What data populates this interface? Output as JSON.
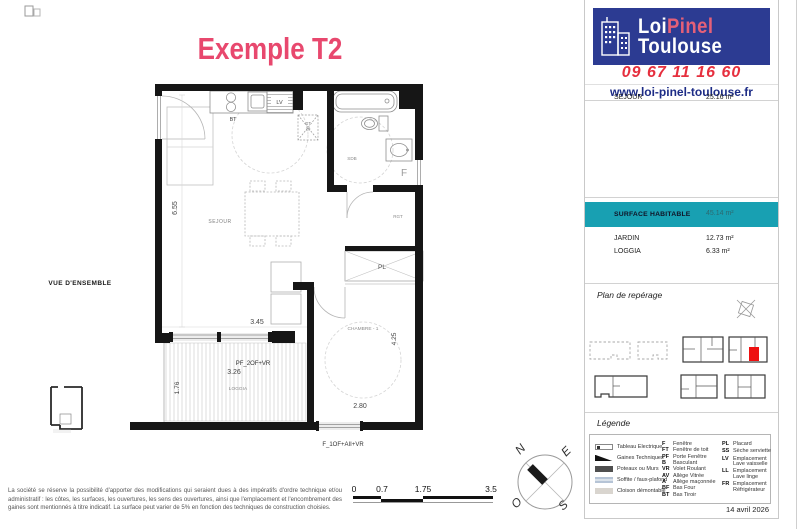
{
  "colors": {
    "accent_pink": "#e8486e",
    "brand_blue": "#2c3b92",
    "phone_red": "#e62f3e",
    "link_blue": "#1d2c86",
    "teal": "#18a0b2",
    "unit_red": "#ee1010"
  },
  "header": {
    "title": "Exemple T2"
  },
  "branding": {
    "logo_word1": "Loi",
    "logo_word2": "Pinel",
    "logo_word3": "Toulouse",
    "phone": "09 67 11 16 60",
    "website": "www.loi-pinel-toulouse.fr"
  },
  "areas": {
    "rows": [
      {
        "label": "SEJOUR",
        "value": "25.16 m²"
      }
    ],
    "highlight": {
      "label": "SURFACE HABITABLE",
      "value": "45.14 m²"
    },
    "annex_rows": [
      {
        "label": "JARDIN",
        "value": "12.73 m²"
      },
      {
        "label": "LOGGIA",
        "value": "6.33 m²"
      }
    ]
  },
  "reperage": {
    "title": "Plan de repérage"
  },
  "legend": {
    "title": "Légende",
    "materials": [
      {
        "name": "Tableau Electrique"
      },
      {
        "name": "Gaines Techniques"
      },
      {
        "name": "Poteaux ou Murs"
      },
      {
        "name": "Soffite / faux-plafond"
      },
      {
        "name": "Cloison démontable"
      }
    ],
    "codes": [
      {
        "code": "F",
        "label": "Fenêtre"
      },
      {
        "code": "FT",
        "label": "Fenêtre de toit"
      },
      {
        "code": "PF",
        "label": "Porte Fenêtre"
      },
      {
        "code": "B",
        "label": "Basculant"
      },
      {
        "code": "VR",
        "label": "Volet Roulant"
      },
      {
        "code": "AV",
        "label": "Allège Vitrée"
      },
      {
        "code": "A",
        "label": "Allège maçonnée"
      },
      {
        "code": "BF",
        "label": "Bas Four"
      },
      {
        "code": "BT",
        "label": "Bas Tiroir"
      }
    ],
    "codes2": [
      {
        "code": "PL",
        "label": "Placard"
      },
      {
        "code": "SS",
        "label": "Sèche serviette"
      },
      {
        "code": "LV",
        "label": "Emplacement Lave vaisselle"
      },
      {
        "code": "LL",
        "label": "Emplacement Lave linge"
      },
      {
        "code": "FR",
        "label": "Emplacement Réfrigérateur"
      }
    ]
  },
  "plan": {
    "view_label": "VUE D'ENSEMBLE",
    "labels": {
      "sejour": "SEJOUR",
      "sdb": "SDB",
      "chambre": "CHAMBRE - 1",
      "loggia": "LOGGIA",
      "pl": "PL",
      "rgt": "RGT",
      "f": "F",
      "lv": "LV",
      "bt": "BT",
      "gt": "GT",
      "gt2": "20"
    },
    "dims": {
      "h_left": "6.55",
      "sejour_w": "3.45",
      "loggia_w": "3.26",
      "loggia_h": "1.76",
      "chambre_w": "2.80",
      "chambre_h": "4.25"
    },
    "windows": {
      "loggia": "PF_2OF+VR",
      "chambre": "F_1OF+AII+VR"
    },
    "compass": {
      "n": "N",
      "e": "E",
      "s": "S",
      "o": "O"
    }
  },
  "scalebar": {
    "labels": [
      "0",
      "0.7",
      "1.75",
      "3.5"
    ]
  },
  "footer": {
    "disclaimer": "La société se réserve la possibilité d'apporter des modifications qui seraient dues à des impératifs d'ordre technique et/ou administratif : les côtes, les surfaces, les ouvertures, les sens des ouvertures, ainsi que l'emplacement et l'encombrement des gaines sont mentionnés à titre indicatif. La surface peut varier de 5% en fonction des techniques de construction choisies.",
    "date": "14 avril 2026"
  }
}
